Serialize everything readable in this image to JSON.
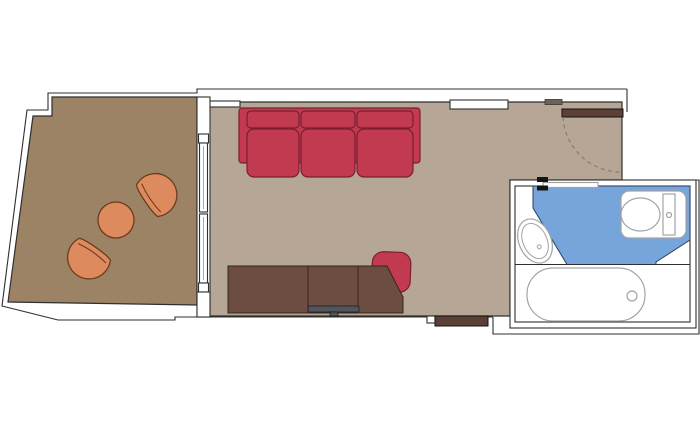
{
  "app": {
    "type": "floor-plan",
    "subject": "stateroom-with-balcony-floorplan"
  },
  "colors": {
    "background": "#ffffff",
    "wall_line": "#2f2f2f",
    "balcony_floor": "#9c8365",
    "room_floor": "#b5a696",
    "sofa": "#c23a50",
    "sofa_outline": "#7a1e30",
    "cabinet": "#6d4d42",
    "cabinet_outline": "#33251f",
    "tv": "#50565b",
    "balcony_furniture": "#dd8a5e",
    "balcony_furniture_outline": "#6b3b1d",
    "wet_area": "#76a5dc",
    "wet_area_outline": "#2c4058",
    "fixture_outline": "#a0a4a7",
    "entry_door": "#5c4038",
    "door_frame": "#6e6258",
    "wall_insert": "#5a4036",
    "door_swing": "#8b7b6b"
  },
  "objects": [
    "balcony",
    "living-sleeping-area",
    "entry",
    "bathroom",
    "balcony-armchair",
    "balcony-armchair",
    "balcony-side-table",
    "sofa-bed",
    "desk-cabinet",
    "tv",
    "desk-chair",
    "sliding-glass-door",
    "entry-door",
    "bathroom-door",
    "washbasin",
    "toilet",
    "bathtub",
    "wet-area-floor"
  ]
}
